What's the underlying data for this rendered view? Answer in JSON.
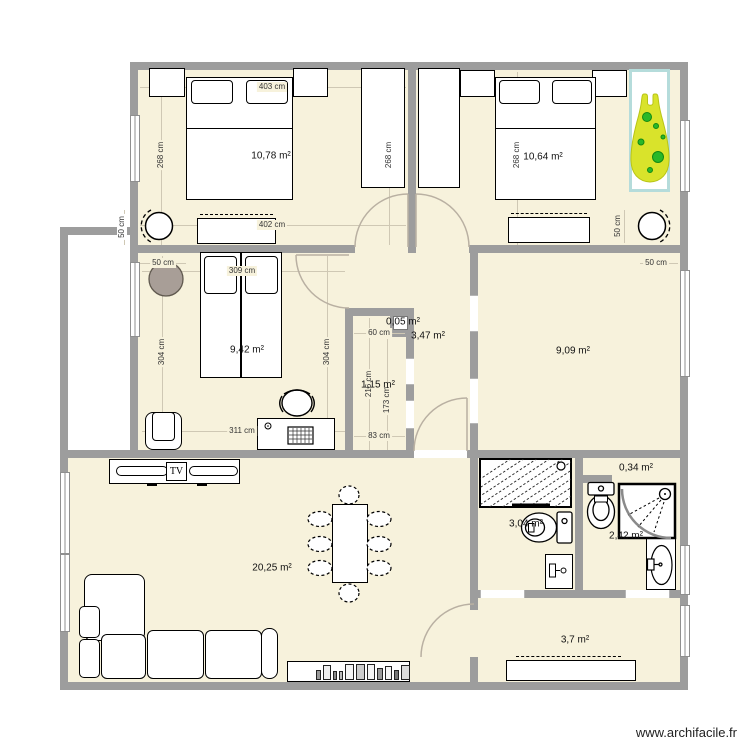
{
  "app": {
    "watermark": "www.archifacile.fr"
  },
  "colors": {
    "floor": "#f7f2dc",
    "wall": "#9d9d9d",
    "dim_line": "#cfc8b4",
    "door_arc": "#b9b0a2",
    "plant_leaf": "#d9e32b",
    "plant_spot": "#29b829",
    "planter_border": "#b5dcdb",
    "pouf": "#a89e97"
  },
  "rooms": [
    {
      "name": "bedroom-1",
      "area": "10,78 m²"
    },
    {
      "name": "bedroom-2",
      "area": "10,64 m²"
    },
    {
      "name": "bedroom-3",
      "area": "9,42 m²"
    },
    {
      "name": "shaft",
      "area": "0,05 m²"
    },
    {
      "name": "hallway",
      "area": "3,47 m²"
    },
    {
      "name": "closet",
      "area": "1,15 m²"
    },
    {
      "name": "office",
      "area": "9,09 m²"
    },
    {
      "name": "living-room",
      "area": "20,25 m²"
    },
    {
      "name": "bathroom",
      "area": "3,04 m²"
    },
    {
      "name": "niche",
      "area": "0,34 m²"
    },
    {
      "name": "shower-room",
      "area": "2,42 m²"
    },
    {
      "name": "entry",
      "area": "3,7 m²"
    }
  ],
  "dimensions": [
    {
      "id": "dim-403",
      "text": "403 cm"
    },
    {
      "id": "dim-268-left",
      "text": "268 cm"
    },
    {
      "id": "dim-268-mid",
      "text": "268 cm"
    },
    {
      "id": "dim-268-right",
      "text": "268 cm"
    },
    {
      "id": "dim-402",
      "text": "402 cm"
    },
    {
      "id": "dim-50-outer-left",
      "text": "50 cm"
    },
    {
      "id": "dim-50-bedroom2",
      "text": "50 cm"
    },
    {
      "id": "dim-50-bedroom3",
      "text": "50 cm"
    },
    {
      "id": "dim-50-office",
      "text": "50 cm"
    },
    {
      "id": "dim-309",
      "text": "309 cm"
    },
    {
      "id": "dim-304-left",
      "text": "304 cm"
    },
    {
      "id": "dim-304-right",
      "text": "304 cm"
    },
    {
      "id": "dim-311",
      "text": "311 cm"
    },
    {
      "id": "dim-60",
      "text": "60 cm"
    },
    {
      "id": "dim-216",
      "text": "216 cm"
    },
    {
      "id": "dim-173",
      "text": "173 cm"
    },
    {
      "id": "dim-83",
      "text": "83 cm"
    }
  ],
  "furniture_labels": {
    "tv": "TV"
  },
  "furniture": [
    "double-bed",
    "single-bed",
    "nightstand",
    "wardrobe",
    "dresser",
    "round-chair",
    "pouf",
    "armchair",
    "desk",
    "office-chair",
    "keyboard",
    "tv-stand",
    "dining-table",
    "dining-chair",
    "corner-sofa",
    "shelf-with-books",
    "bathtub",
    "toilet",
    "washbasin",
    "corner-shower",
    "bathroom-cabinet",
    "sideboard",
    "plant"
  ]
}
